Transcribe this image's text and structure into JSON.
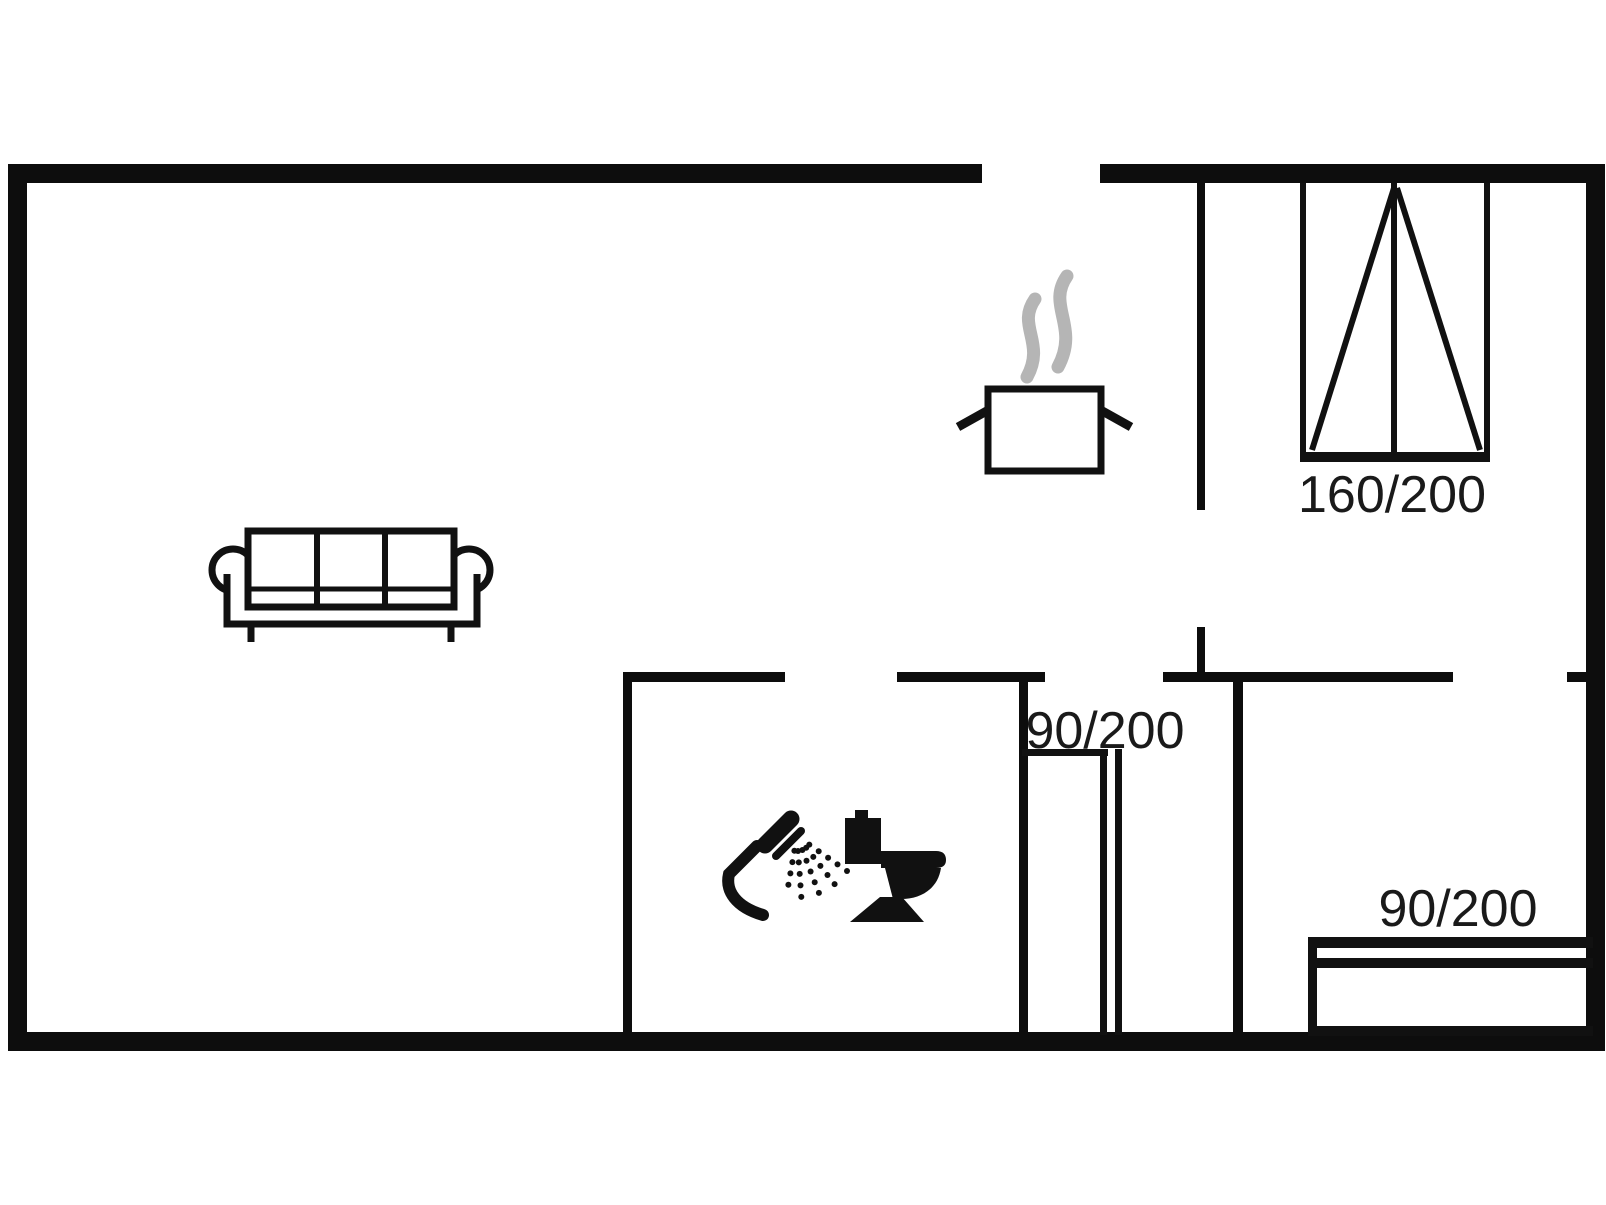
{
  "diagram": {
    "type": "floor-plan",
    "background_color": "#ffffff",
    "wall_color": "#0d0d0d",
    "line_color": "#111111",
    "steam_color": "#b5b5b5",
    "text_color": "#1a1a1a",
    "labels": [
      {
        "id": "double-bed-size",
        "text": "160/200"
      },
      {
        "id": "alcove-bed-size",
        "text": "90/200"
      },
      {
        "id": "right-bed-size",
        "text": "90/200"
      }
    ],
    "walls": {
      "outer": [
        {
          "name": "top-wall-left",
          "rect": [
            8,
            164,
            974,
            19
          ]
        },
        {
          "name": "top-wall-right",
          "rect": [
            1100,
            164,
            505,
            19
          ]
        },
        {
          "name": "left-wall",
          "rect": [
            8,
            164,
            19,
            887
          ]
        },
        {
          "name": "right-wall",
          "rect": [
            1586,
            164,
            19,
            887
          ]
        },
        {
          "name": "bottom-wall",
          "rect": [
            8,
            1032,
            1597,
            19
          ]
        }
      ],
      "interior": [
        {
          "name": "kitchen-divider-upper",
          "rect": [
            1197,
            183,
            8,
            327
          ]
        },
        {
          "name": "kitchen-divider-stub",
          "rect": [
            1197,
            627,
            8,
            47
          ]
        },
        {
          "name": "hall-top-wall",
          "rect": [
            1163,
            672,
            290,
            10
          ]
        },
        {
          "name": "hall-top-wall-right-stub",
          "rect": [
            1567,
            672,
            19,
            10
          ]
        },
        {
          "name": "bathroom-top-wall-left",
          "rect": [
            623,
            672,
            162,
            10
          ]
        },
        {
          "name": "bathroom-top-wall-right",
          "rect": [
            897,
            672,
            148,
            10
          ]
        },
        {
          "name": "bathroom-left-wall",
          "rect": [
            623,
            672,
            9,
            360
          ]
        },
        {
          "name": "bathroom-right-wall",
          "rect": [
            1019,
            672,
            9,
            360
          ]
        },
        {
          "name": "bedroom-partition-wall",
          "rect": [
            1233,
            672,
            10,
            360
          ]
        }
      ]
    },
    "openings": [
      {
        "name": "entrance-opening-top-wall",
        "x": 982,
        "y": 164,
        "width": 118
      },
      {
        "name": "kitchen-passage",
        "x": 1197,
        "y": 510,
        "height": 117
      },
      {
        "name": "bathroom-door-opening",
        "x": 785,
        "y": 672,
        "width": 112
      },
      {
        "name": "alcove-opening",
        "x": 1045,
        "y": 672,
        "width": 118
      },
      {
        "name": "bedroom-door-opening",
        "x": 1453,
        "y": 672,
        "width": 114
      }
    ],
    "furniture": [
      {
        "name": "sofa",
        "room": "living-area"
      },
      {
        "name": "cooking-pot",
        "room": "kitchen"
      },
      {
        "name": "shower",
        "room": "bathroom"
      },
      {
        "name": "toilet",
        "room": "bathroom"
      },
      {
        "name": "double-bed",
        "size_label": "160/200"
      },
      {
        "name": "single-bed-alcove",
        "size_label": "90/200"
      },
      {
        "name": "single-bed-right",
        "size_label": "90/200"
      }
    ]
  }
}
